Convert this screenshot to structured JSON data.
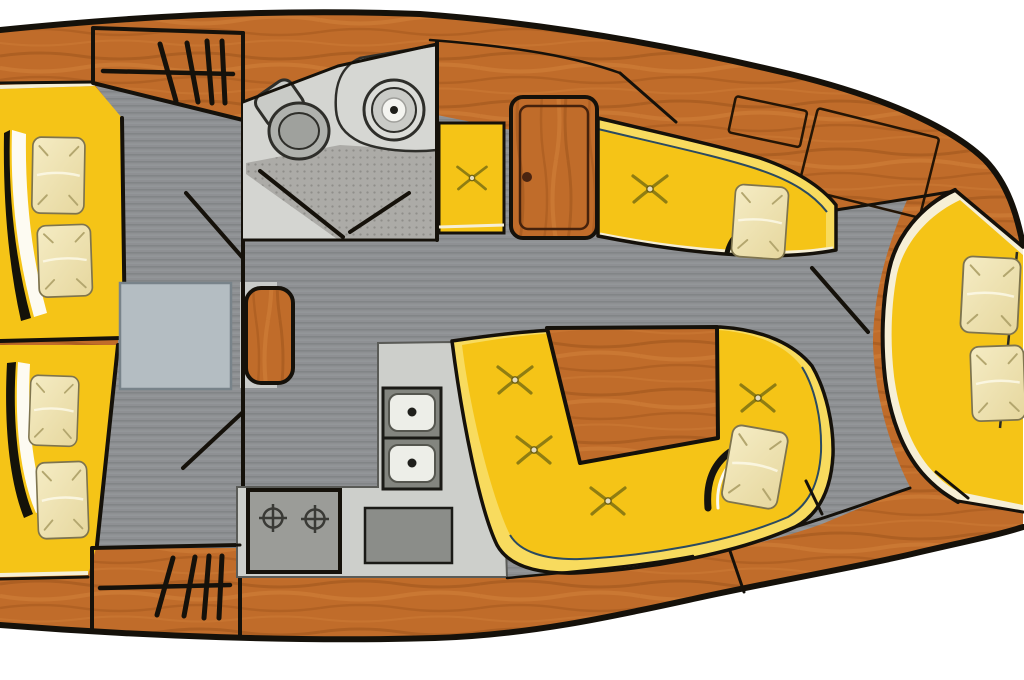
{
  "diagram": {
    "kind": "sailing-yacht-interior-floor-plan",
    "regions": [
      {
        "name": "forward-cabin",
        "items": [
          "v-berth-port",
          "v-berth-starboard",
          "pillows",
          "hanging-locker-port",
          "hanging-locker-starboard",
          "blanket-folds"
        ]
      },
      {
        "name": "head-compartment",
        "items": [
          "toilet",
          "washbasin",
          "vanity-counter",
          "shower-floor",
          "door-swing"
        ]
      },
      {
        "name": "saloon",
        "items": [
          "starboard-settee",
          "dinette-settee",
          "dinette-table",
          "stool",
          "lowered-table-infill",
          "button-tufts",
          "pillows"
        ]
      },
      {
        "name": "galley",
        "items": [
          "double-sink",
          "two-burner-stove",
          "worktop-lid",
          "l-shaped-counter"
        ]
      },
      {
        "name": "aft-cabin",
        "items": [
          "double-berth",
          "pillows",
          "door-swing",
          "cockpit-locker-panels"
        ]
      }
    ],
    "colors": {
      "wood": "#C06C2A",
      "wood-dark": "#8F4A14",
      "wood-light": "#D8873E",
      "outline": "#15110A",
      "cushion": "#F5C417",
      "cushion-pale": "#F8DB5E",
      "edge-line": "#2B4A60",
      "cream": "#F6EFD6",
      "pillow": "#F5ECC4",
      "pillow-shade": "#E6D79E",
      "floor": "#8E9093",
      "floor-stripe": "#7F8285",
      "floor-stripe2": "#9A9DA0",
      "head-floor": "#D4D5D1",
      "shower-bg": "#ACABA7",
      "shower-dot": "#8F8E8A",
      "fixture": "#C7C9C5",
      "fixture-dark": "#2E2E2A",
      "counter": "#CDCFCB",
      "appliance": "#9B9C98",
      "appliance-dark": "#8B8D89",
      "mast": "#B4BDC2",
      "bg": "#FFFFFF"
    }
  }
}
